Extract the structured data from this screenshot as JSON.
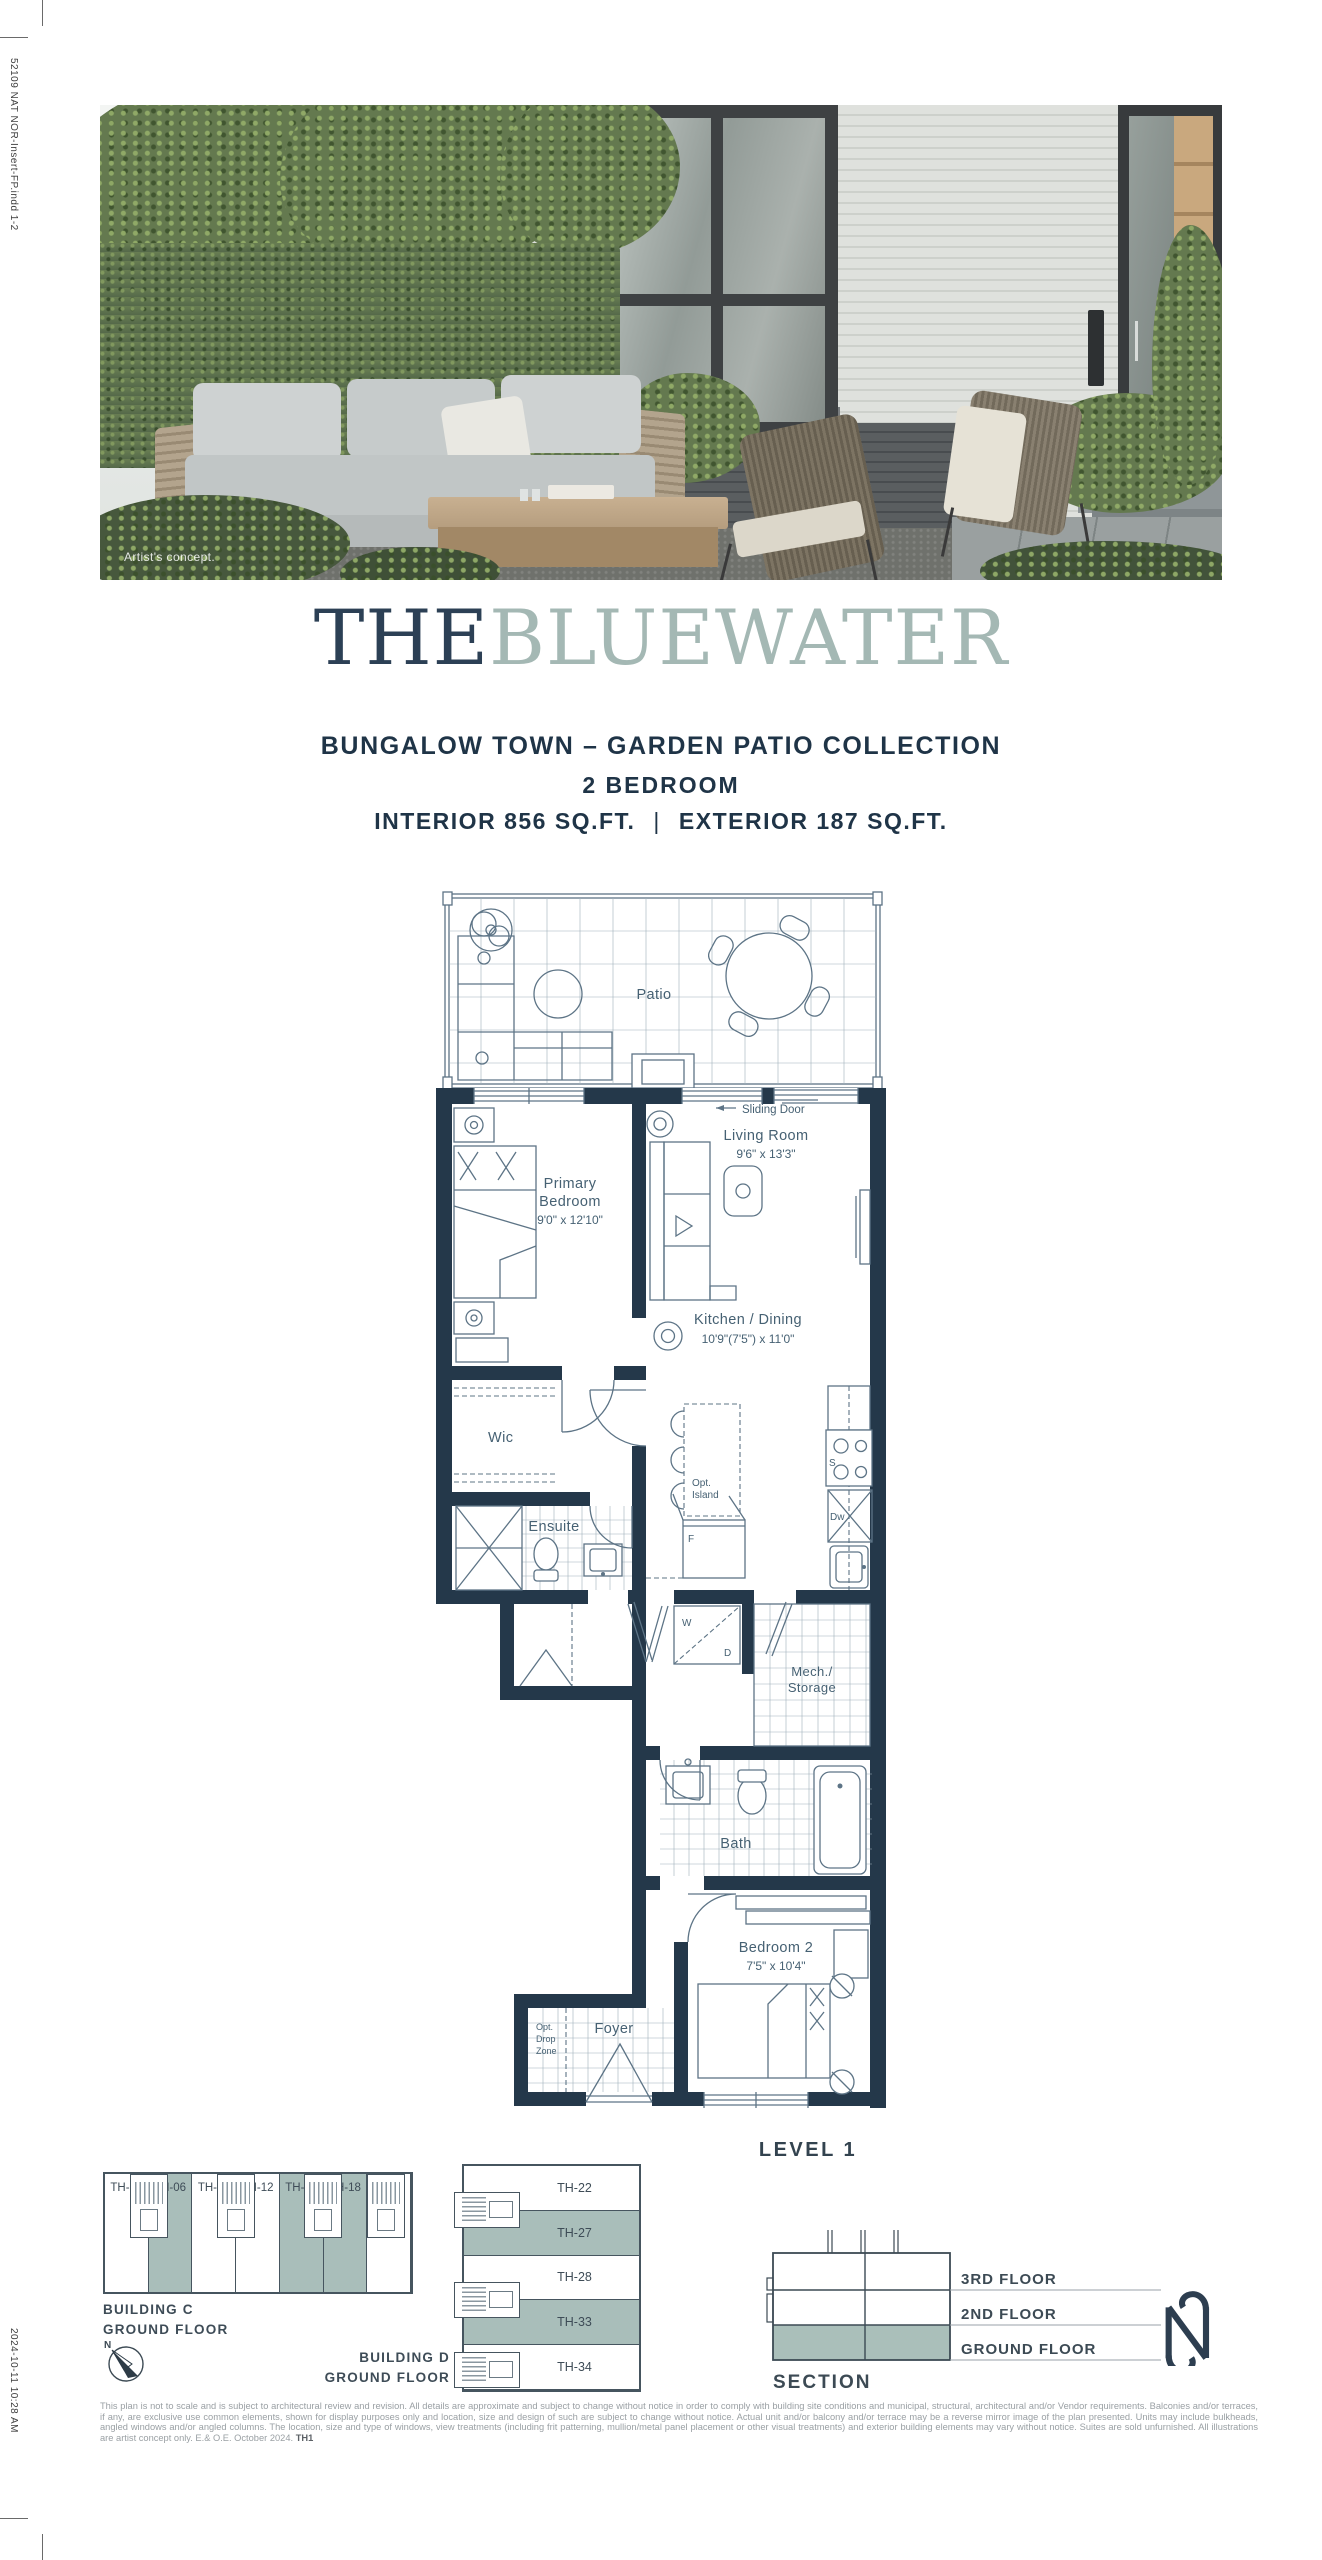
{
  "print_marks": {
    "file_info": "52109 NAT NOR-Insert-FP.indd   1-2",
    "timestamp": "2024-10-11   10:28 AM"
  },
  "photo": {
    "caption": "Artist's concept."
  },
  "header": {
    "brand_the": "THE",
    "brand_name": "BLUEWATER",
    "collection": "BUNGALOW TOWN – GARDEN PATIO COLLECTION",
    "bedrooms": "2 BEDROOM",
    "area_interior": "INTERIOR 856 SQ.FT.",
    "area_separator": "|",
    "area_exterior": "EXTERIOR 187 SQ.FT."
  },
  "floor_plan": {
    "level_label": "LEVEL 1",
    "patio": "Patio",
    "sliding_door": "Sliding Door",
    "living_name": "Living Room",
    "living_dims": "9'6\" x 13'3\"",
    "primary_name1": "Primary",
    "primary_name2": "Bedroom",
    "primary_dims": "9'0\" x 12'10\"",
    "kitchen_name": "Kitchen / Dining",
    "kitchen_dims": "10'9\"(7'5\") x 11'0\"",
    "wic": "Wic",
    "ensuite": "Ensuite",
    "island1": "Opt.",
    "island2": "Island",
    "mech1": "Mech./",
    "mech2": "Storage",
    "bath": "Bath",
    "bedroom2_name": "Bedroom 2",
    "bedroom2_dims": "7'5\" x 10'4\"",
    "foyer": "Foyer",
    "drop1": "Opt.",
    "drop2": "Drop",
    "drop3": "Zone",
    "washer": "W",
    "dryer": "D",
    "stove": "S",
    "dishwasher": "Dw",
    "fridge": "F"
  },
  "keyplans": {
    "compass_n": "N",
    "building_c": {
      "label_line1": "BUILDING C",
      "label_line2": "GROUND FLOOR",
      "units": [
        {
          "label": "TH-01",
          "highlighted": false
        },
        {
          "label": "TH-06",
          "highlighted": true
        },
        {
          "label": "TH-07",
          "highlighted": false
        },
        {
          "label": "TH-12",
          "highlighted": false
        },
        {
          "label": "TH-13",
          "highlighted": true
        },
        {
          "label": "TH-18",
          "highlighted": true
        },
        {
          "label": "TH-19",
          "highlighted": false
        }
      ]
    },
    "building_d": {
      "label_line1": "BUILDING D",
      "label_line2": "GROUND FLOOR",
      "units": [
        {
          "label": "TH-22",
          "highlighted": false
        },
        {
          "label": "TH-27",
          "highlighted": true
        },
        {
          "label": "TH-28",
          "highlighted": false
        },
        {
          "label": "TH-33",
          "highlighted": true
        },
        {
          "label": "TH-34",
          "highlighted": false
        }
      ]
    },
    "section": {
      "title": "SECTION",
      "floors": [
        "3RD FLOOR",
        "2ND FLOOR",
        "GROUND FLOOR"
      ]
    }
  },
  "footer": {
    "disclaimer": "This plan is not to scale and is subject to architectural review and revision. All details are approximate and subject to change without notice in order to comply with building site conditions and municipal, structural, architectural and/or Vendor requirements. Balconies and/or terraces, if any, are exclusive use common elements, shown for display purposes only and location, size and design of such are subject to change without notice. Actual unit and/or balcony and/or terrace may be a reverse mirror image of the plan presented. Units may include bulkheads, angled windows and/or angled columns. The location, size and type of windows, view treatments (including frit patterning, mullion/metal panel placement or other visual treatments) and exterior building elements may vary without notice. Suites are sold unfurnished. All illustrations are artist concept only. E.& O.E. October 2024.",
    "plan_code": "TH1"
  },
  "colors": {
    "navy": "#24384a",
    "sage": "#a4b8b4",
    "highlight": "#a9beba"
  }
}
